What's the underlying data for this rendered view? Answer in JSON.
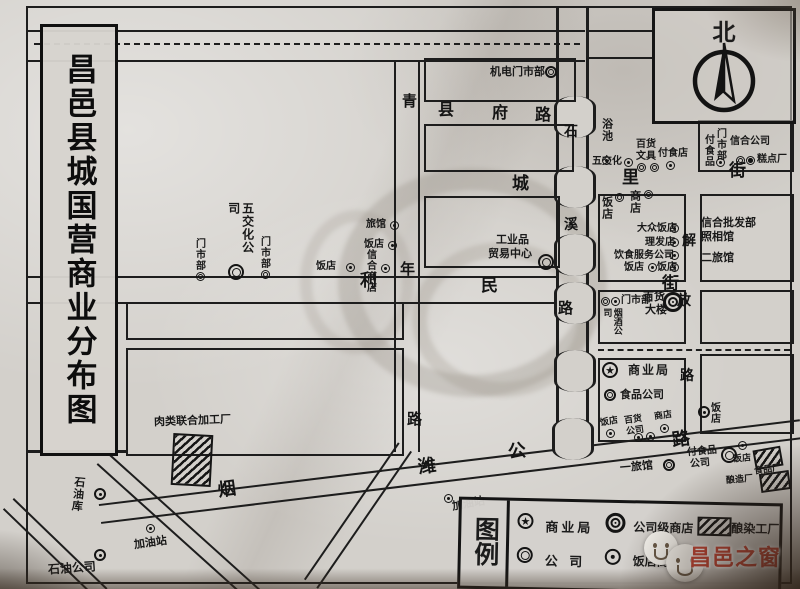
{
  "title": "昌邑县城国营商业分布图",
  "compass": {
    "north": "北"
  },
  "watermark": "昌邑之窗",
  "colors": {
    "paper": "#d3d0cb",
    "ink": "#1d1d1d",
    "watermark_red": "#c94434"
  },
  "streets": {
    "qingnian": [
      "青",
      "年",
      "路"
    ],
    "xianfu": [
      "县",
      "府",
      "路"
    ],
    "chengli": [
      "城",
      "里",
      "街"
    ],
    "limin": [
      "利",
      "民",
      "路"
    ],
    "east_street": [
      "街"
    ],
    "jiefang": [
      "解",
      "放",
      "路"
    ],
    "yanwei": [
      "烟",
      "潍",
      "公",
      "路"
    ],
    "river": [
      "石",
      "溪"
    ]
  },
  "pois": [
    {
      "label": "机电门市部"
    },
    {
      "label": "浴池"
    },
    {
      "label": "五交化"
    },
    {
      "label": "百货",
      "label2": "文具"
    },
    {
      "label": "付食店"
    },
    {
      "label": "门市部"
    },
    {
      "label": "付食品"
    },
    {
      "label": "信合公司"
    },
    {
      "label": "糕点厂"
    },
    {
      "label": "饭店"
    },
    {
      "label": "商店"
    },
    {
      "label": "大众饭店"
    },
    {
      "label": "理发店"
    },
    {
      "label": "饮食服务公司"
    },
    {
      "label": "饭店"
    },
    {
      "label": "饭店"
    },
    {
      "label": "信合批发部"
    },
    {
      "label": "照相馆"
    },
    {
      "label": "二旅馆"
    },
    {
      "label": "五交化公司"
    },
    {
      "label": "门市部"
    },
    {
      "label": "门市部"
    },
    {
      "label": "旅馆"
    },
    {
      "label": "饭店"
    },
    {
      "label": "信合商店"
    },
    {
      "label": "饭店"
    },
    {
      "label": "工业品",
      "label2": "贸易中心"
    },
    {
      "label": "门市部"
    },
    {
      "label": "百货",
      "label2": "大楼"
    },
    {
      "label": "烟酒公司"
    },
    {
      "label": "商业局"
    },
    {
      "label": "食品公司"
    },
    {
      "label": "饭店"
    },
    {
      "label": "百货",
      "label2": "公司"
    },
    {
      "label": "商店"
    },
    {
      "label": "饭店"
    },
    {
      "label": "一旅馆"
    },
    {
      "label": "付食品",
      "label2": "公司"
    },
    {
      "label": "饭店"
    },
    {
      "label": "食品厂"
    },
    {
      "label": "酿造厂"
    },
    {
      "label": "肉类联合加工厂"
    },
    {
      "label": "石油库"
    },
    {
      "label": "加油站"
    },
    {
      "label": "加油站"
    },
    {
      "label": "石油公司"
    }
  ],
  "legend": {
    "title": "图例",
    "items": [
      {
        "symbol": "star-circle",
        "label": "商业局"
      },
      {
        "symbol": "double-circle",
        "label": "公 司"
      },
      {
        "symbol": "triple-circle",
        "label": "公司级商店"
      },
      {
        "symbol": "dot-circle",
        "label": "饭店商店"
      },
      {
        "symbol": "hatch",
        "label": "酿染工厂"
      }
    ]
  }
}
